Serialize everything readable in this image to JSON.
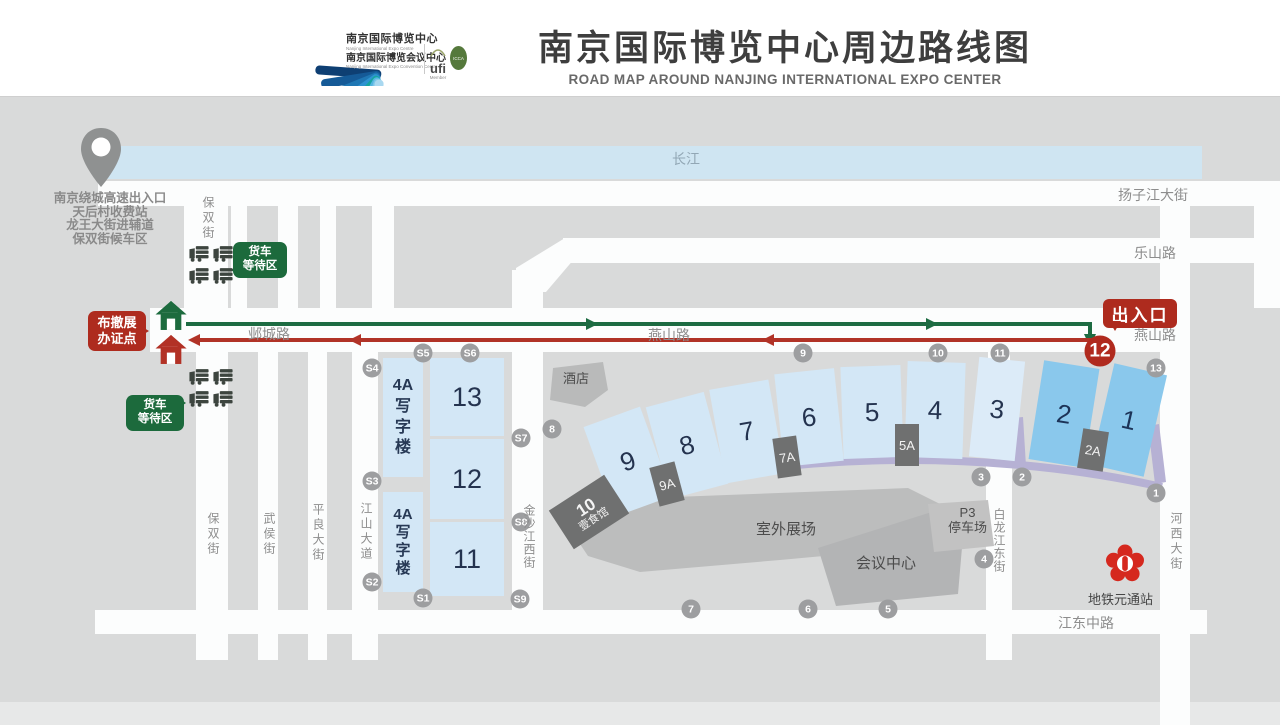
{
  "header": {
    "logo": {
      "cn1": "南京国际博览中心",
      "en1": "Nanjing International Expo Centre",
      "cn2": "南京国际博览会议中心",
      "en2": "Nanjing International Expo Convention Centre",
      "ufi": "ufi",
      "ufi_member": "Member",
      "icca": "ICCA"
    },
    "title_cn": "南京国际博览中心周边路线图",
    "title_en": "ROAD MAP AROUND NANJING INTERNATIONAL EXPO CENTER"
  },
  "map": {
    "river_label": "长江",
    "roads": {
      "yangzijiang": "扬子江大街",
      "leshan": "乐山路",
      "yecheng": "邺城路",
      "yanshan": "燕山路",
      "yanshan_e": "燕山路",
      "jiangdong": "江东中路",
      "baoshuang_n": "保双街",
      "baoshuang": "保双街",
      "wuhou": "武侯街",
      "pingliang": "平良大街",
      "jiangshan": "江山大道",
      "jinshajiang": "金沙江西街",
      "bailongjiang": "白龙江东街",
      "hexi": "河西大街"
    },
    "note": [
      "南京绕城高速出入口",
      "天后村收费站",
      "龙王大街进辅道",
      "保双街候车区"
    ],
    "badges": {
      "permit": [
        "布撤展",
        "办证点"
      ],
      "truck_wait": [
        "货车",
        "等待区"
      ],
      "entrance": "出入口"
    },
    "halls": {
      "h1": "1",
      "h2": "2",
      "h3": "3",
      "h4": "4",
      "h5": "5",
      "h6": "6",
      "h7": "7",
      "h8": "8",
      "h9": "9",
      "h11": "11",
      "h12": "12",
      "h13": "13",
      "a2": "2A",
      "a5": "5A",
      "a7": "7A",
      "a9": "9A"
    },
    "office": [
      "4A",
      "写",
      "字",
      "楼"
    ],
    "places": {
      "hotel": "酒店",
      "outdoor": "室外展场",
      "conference": "会议中心",
      "parking_line1": "P3",
      "parking_line2": "停车场",
      "food_num": "10",
      "food_name": "壹食馆",
      "metro": "地铁元通站"
    },
    "gates_s": [
      "S1",
      "S2",
      "S3",
      "S4",
      "S5",
      "S6",
      "S7",
      "S8",
      "S9"
    ],
    "gates_num": [
      "1",
      "2",
      "3",
      "4",
      "5",
      "6",
      "7",
      "8",
      "9",
      "10",
      "11",
      "13"
    ],
    "gate_12": "12"
  },
  "colors": {
    "route_green": "#1d6b42",
    "route_red": "#b13327",
    "badge_red": "#ae2b1e",
    "badge_green": "#1c6a3c",
    "hall_light": "#d3e7f6",
    "hall_dark": "#8ac8ec",
    "river": "#cfe5f2"
  }
}
